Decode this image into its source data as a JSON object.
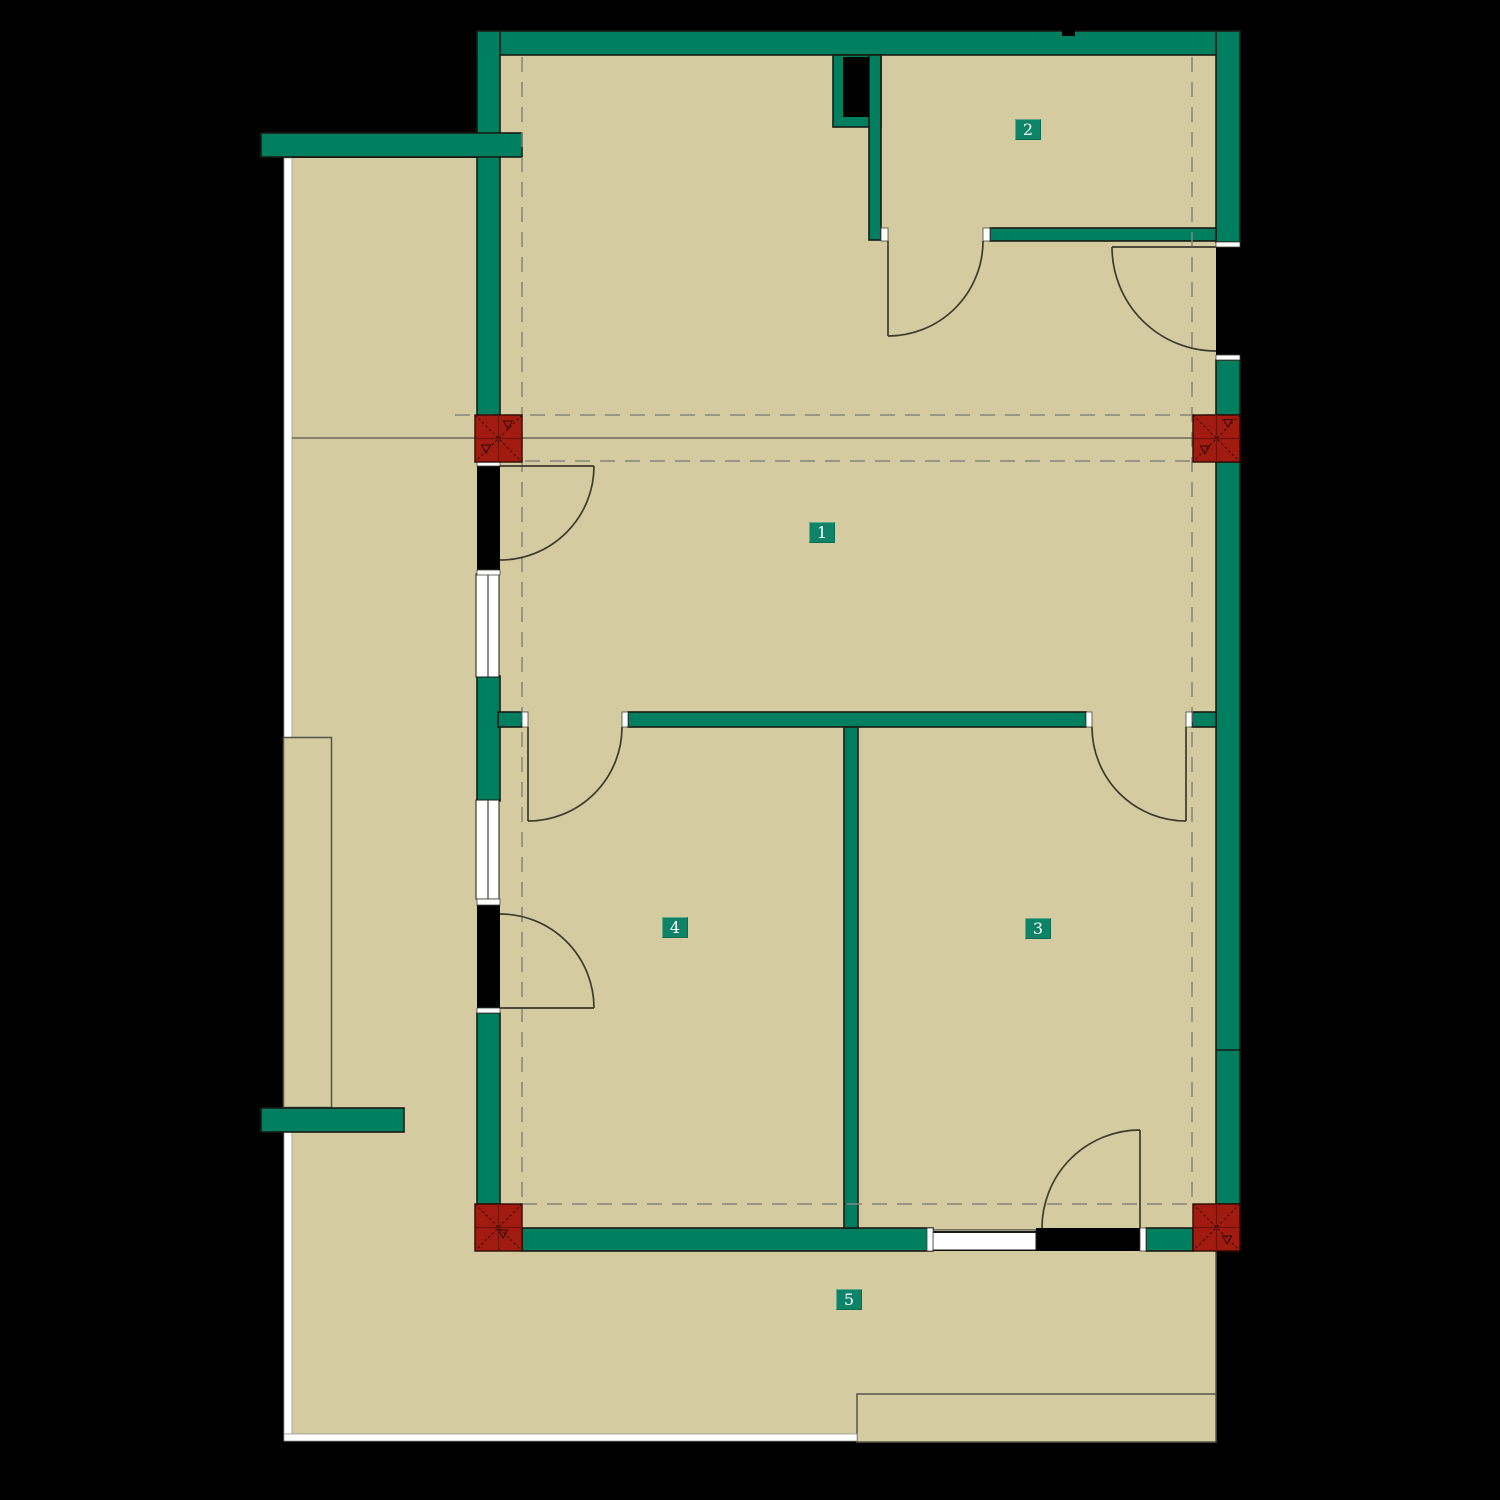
{
  "meta": {
    "kind": "architectural-floor-plan",
    "background": "black"
  },
  "colors": {
    "background": "#000000",
    "floor_tan": "#D4CBA1",
    "wall_green": "#007E60",
    "column_red": "#A21B10",
    "column_line": "#2E0B05",
    "label_green": "#0D8468",
    "label_text": "#FFFFFF",
    "dashed_gray": "#85857D",
    "outline_dark": "#1C1B13",
    "door_line": "#3E3B2F",
    "window_white": "#FFFFFF"
  },
  "rooms": [
    {
      "id": "room-1",
      "label": "1",
      "style": "left:809px;top:522px"
    },
    {
      "id": "room-2",
      "label": "2",
      "style": "left:1015px;top:119px"
    },
    {
      "id": "room-3",
      "label": "3",
      "style": "left:1025px;top:918px"
    },
    {
      "id": "room-4",
      "label": "4",
      "style": "left:662px;top:917px"
    },
    {
      "id": "room-5",
      "label": "5",
      "style": "left:836px;top:1289px"
    }
  ],
  "plan": {
    "columns": [
      {
        "id": "column-top-left",
        "x": 475,
        "y": 415
      },
      {
        "id": "column-top-right",
        "x": 1193,
        "y": 415
      },
      {
        "id": "column-bottom-left",
        "x": 475,
        "y": 1204
      },
      {
        "id": "column-bottom-right",
        "x": 1193,
        "y": 1204
      }
    ],
    "doors_count": 7,
    "windows_count": 3,
    "outdoor_areas": [
      "left-yard",
      "bottom-terrace",
      "terrace-step"
    ]
  }
}
